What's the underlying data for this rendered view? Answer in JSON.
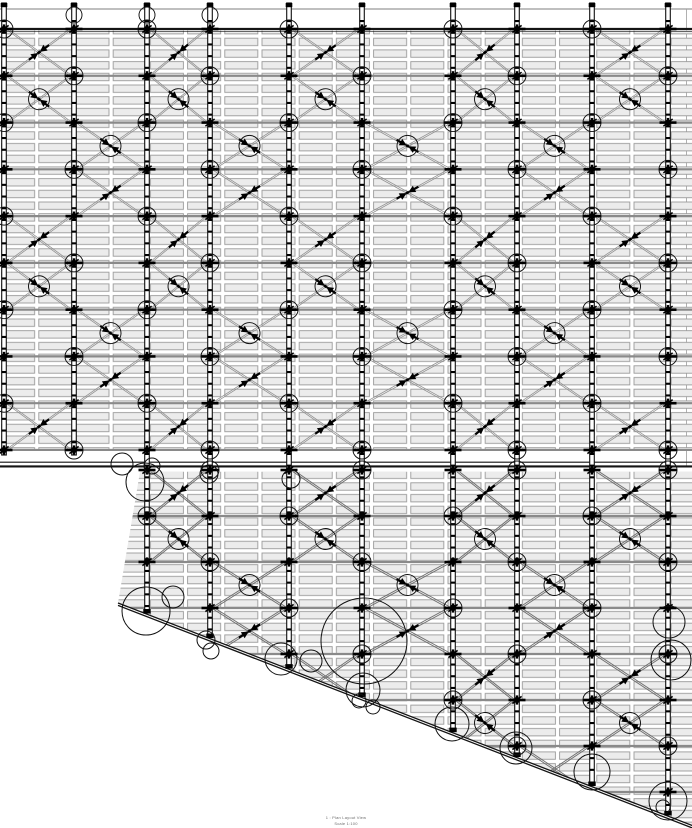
{
  "page": {
    "background": "#ffffff"
  },
  "view_title": {
    "line1": "1 : Plan Layout View",
    "line2": "Scale 1:100"
  },
  "drawing": {
    "width": 692,
    "height": 828,
    "colors": {
      "ink": "#141414",
      "post_stroke": "#181818",
      "row_line": "#8a8a8a",
      "brace_top": "#8f8f8f",
      "brace_bottom": "#6f6f6f",
      "plank_fill": "#ececec",
      "plank_stroke": "#9a9a9a",
      "thin_gray": "#9d9d9d",
      "circle": "#101010",
      "symbol": "#000000"
    },
    "posts_x": [
      4,
      74,
      147,
      210,
      289,
      362,
      453,
      517,
      592,
      668
    ],
    "top_block": {
      "x_left": 0,
      "x_right": 692,
      "thin_line_y": 9,
      "chord_y": 29,
      "rows_start": 29,
      "rows_end": 450,
      "row_count": 10,
      "right_edge_line_x": 686.5
    },
    "junction": {
      "line1_y": 462.2,
      "line2_y": 466.4
    },
    "bottom_block": {
      "x_left": 140,
      "x_right": 692,
      "rows_start": 470,
      "row_pitch": 46,
      "row_count": 8,
      "posts_from_index": 2
    },
    "boundary": {
      "x1": 118,
      "y1": 603,
      "x2": 696,
      "y2": 827
    },
    "plank": {
      "tile_w": 37.2,
      "tile_h": 11.7
    },
    "cap_circles": [
      [
        74,
        15,
        8
      ],
      [
        147,
        15,
        8
      ],
      [
        210,
        15,
        8
      ]
    ],
    "highlight_circles": [
      [
        122,
        464,
        11
      ],
      [
        152,
        466,
        8
      ],
      [
        145,
        482,
        19
      ],
      [
        209,
        474,
        9
      ],
      [
        291,
        479,
        9
      ],
      [
        146,
        611,
        24
      ],
      [
        173,
        597,
        11
      ],
      [
        206,
        640,
        9
      ],
      [
        211,
        651,
        8
      ],
      [
        281,
        659,
        16
      ],
      [
        311,
        661,
        11
      ],
      [
        364,
        641,
        43
      ],
      [
        363,
        690,
        17
      ],
      [
        359,
        701,
        7
      ],
      [
        373,
        707,
        7
      ],
      [
        452,
        724,
        17
      ],
      [
        516,
        748,
        16
      ],
      [
        592,
        772,
        18
      ],
      [
        669,
        622,
        16
      ],
      [
        671,
        660,
        20
      ],
      [
        668,
        801,
        19
      ],
      [
        663,
        807,
        7
      ]
    ]
  }
}
